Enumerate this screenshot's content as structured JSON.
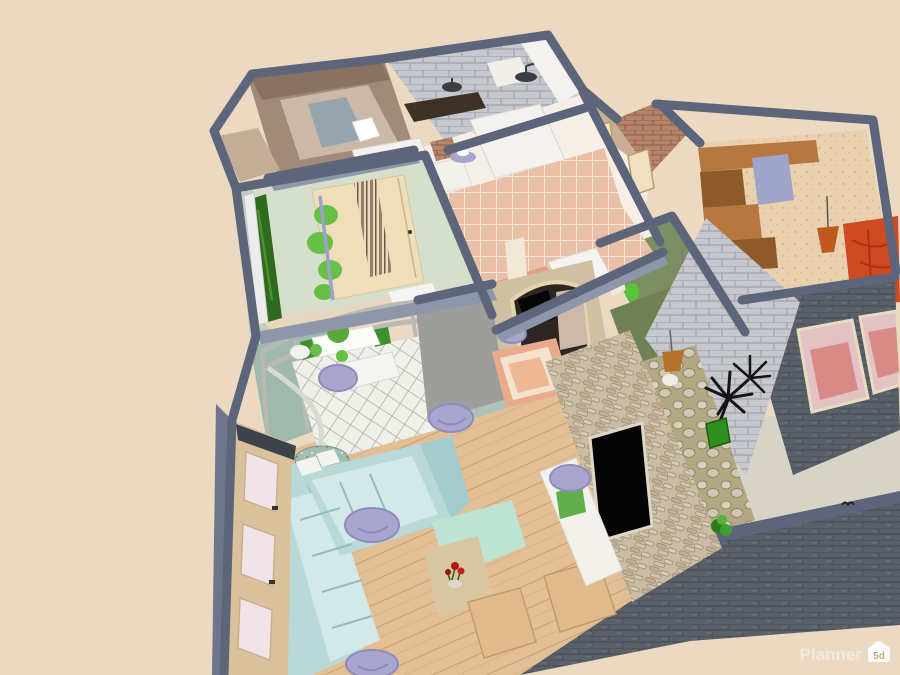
{
  "watermark": {
    "brand": "Planner",
    "badge_label": "5d"
  },
  "icons": {
    "watermark_badge": "house-5d-icon"
  },
  "colors": {
    "background": "#ecd9c2",
    "wall_top": "#5c657a",
    "wall_side": "#8e96aa",
    "wall_side_dark": "#6e7689",
    "outer_brick": "#5a6068",
    "gray_brick": "#c6c8cd",
    "red_brick": "#b5846a",
    "dressing_wall": "#a18a77",
    "dressing_wall_dark": "#8a7262",
    "dressing_floor": "#cbb8a6",
    "dressing_mat": "#96a5ad",
    "marble_floor": "#f6efe8",
    "white_wall": "#f3f2ee",
    "pink_tile": "#e9bfa6",
    "bathtub": "#dfa084",
    "green_room_wall": "#d5dfcc",
    "green_room_wall_shade": "#c2cfc0",
    "wardrobe_cream": "#eedfba",
    "decor_green": "#67bf45",
    "plant_dark": "#2f6b1f",
    "kitchen_glass": "#9fb9ad",
    "frame_gray": "#b9bab6",
    "kitchen_floor": "#eff1e9",
    "gray_wall": "#9d9d9b",
    "arch_beige": "#cfc0a2",
    "rug_border": "#e8ab8c",
    "rug_mid": "#f4e2cf",
    "rug_center": "#efb894",
    "hall_sage": "#7d8e62",
    "hall_olive": "#6f8054",
    "lamp_green": "#55c43a",
    "lamp_yellow": "#e0d53a",
    "straw_lamp": "#b5722c",
    "bedroom_floor": "#e9d0ae",
    "shelf_brown": "#b5773f",
    "shelf_brown_dark": "#8d5a28",
    "door_lilac": "#9fa5c9",
    "pendant_orange": "#bf5a1e",
    "bed_red": "#cf4a22",
    "bed_red_dark": "#a83414",
    "window_pink": "#e3c2c4",
    "stone_wall": "#cbbca4",
    "tv_black": "#050505",
    "wood_floor": "#e3bf95",
    "sofa_blue": "#b9d9d9",
    "sofa_blue_light": "#d3e8e8",
    "sofa_seam": "#93bcbc",
    "lavender": "#a8a5cf",
    "mint_desk": "#bce3d3",
    "table_beige": "#d8c6a2",
    "chair_wood": "#e0ba8a",
    "console_white": "#f2f1ec",
    "planter_green": "#64ad4e",
    "cabinet_tan": "#d9c29b",
    "cabinet_panel": "#f0e4e8",
    "pouf_teal": "#a3bcb0",
    "concrete": "#d7d3c6",
    "cobble": "#b2a984",
    "watermark_text": "#f2ece0",
    "badge_bg": "#ffffff",
    "badge_text": "#c9ab82"
  }
}
